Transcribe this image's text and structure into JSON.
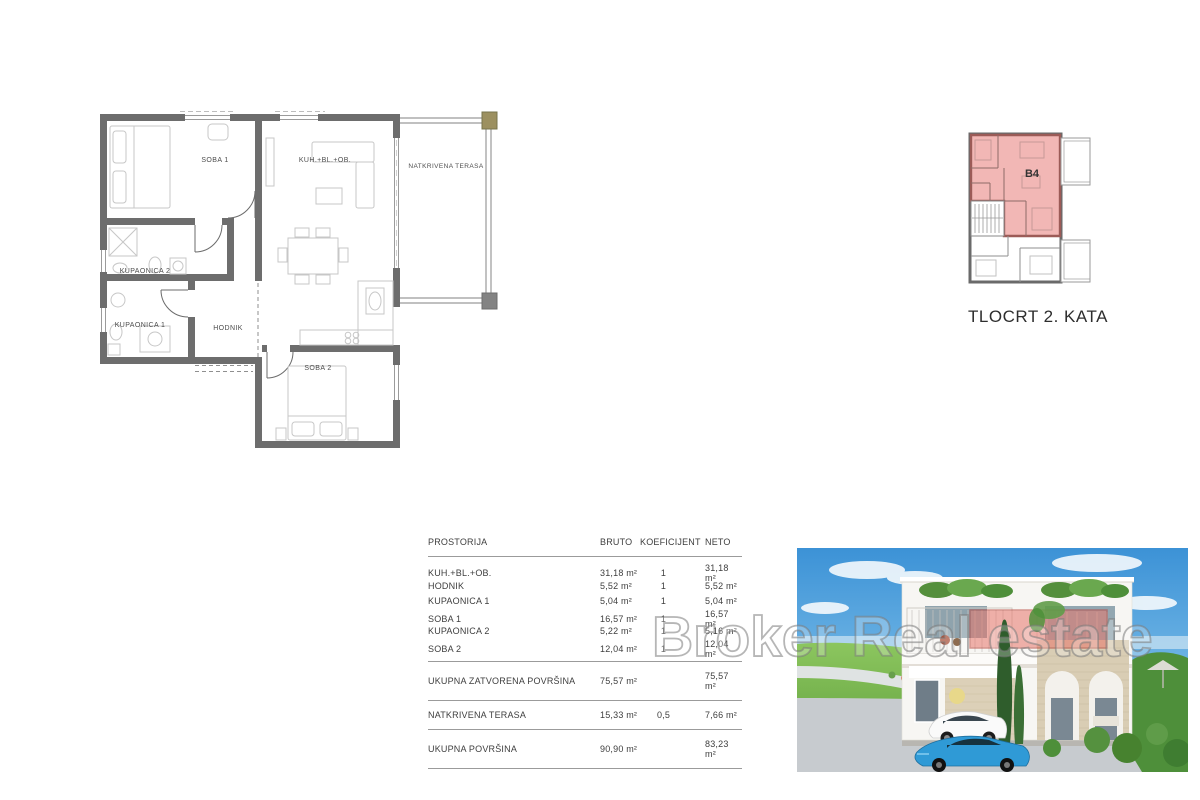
{
  "floor_plan": {
    "labels": {
      "soba1": "SOBA 1",
      "kuhinja": "KUH.+BL.+OB.",
      "terasa": "NATKRIVENA TERASA",
      "kupaonica2": "KUPAONICA 2",
      "kupaonica1": "KUPAONICA 1",
      "hodnik": "HODNIK",
      "soba2": "SOBA 2"
    }
  },
  "mini_plan": {
    "unit": "B4",
    "caption": "TLOCRT 2. KATA"
  },
  "area_table": {
    "headers": {
      "prostorija": "PROSTORIJA",
      "bruto": "BRUTO",
      "koeficijent": "KOEFICIJENT",
      "neto": "NETO"
    },
    "rows": [
      {
        "name": "KUH.+BL.+OB.",
        "bruto": "31,18 m²",
        "koef": "1",
        "neto": "31,18 m²"
      },
      {
        "name": "HODNIK",
        "bruto": "5,52 m²",
        "koef": "1",
        "neto": "5,52 m²"
      },
      {
        "name": "KUPAONICA 1",
        "bruto": "5,04 m²",
        "koef": "1",
        "neto": "5,04 m²"
      },
      {
        "name": "SOBA 1",
        "bruto": "16,57 m²",
        "koef": "1",
        "neto": "16,57 m²"
      },
      {
        "name": "KUPAONICA 2",
        "bruto": "5,22 m²",
        "koef": "1",
        "neto": "5,16 m²"
      },
      {
        "name": "SOBA 2",
        "bruto": "12,04 m²",
        "koef": "1",
        "neto": "12,04 m²"
      }
    ],
    "totals": [
      {
        "name": "UKUPNA ZATVORENA POVRŠINA",
        "bruto": "75,57 m²",
        "koef": "",
        "neto": "75,57 m²"
      },
      {
        "name": "NATKRIVENA TERASA",
        "bruto": "15,33 m²",
        "koef": "0,5",
        "neto": "7,66 m²"
      },
      {
        "name": "UKUPNA POVRŠINA",
        "bruto": "90,90 m²",
        "koef": "",
        "neto": "83,23 m²"
      }
    ]
  },
  "watermark": {
    "text": "Broker Real estate"
  },
  "colors": {
    "wall": "#6d6d6d",
    "furniture_line": "#c7c7c7",
    "unit_highlight_fill": "#f2b7b5",
    "unit_highlight_stroke": "#9c5b57",
    "photo_highlight_stroke": "#b9473f",
    "terrace_column": "#9c9060"
  }
}
